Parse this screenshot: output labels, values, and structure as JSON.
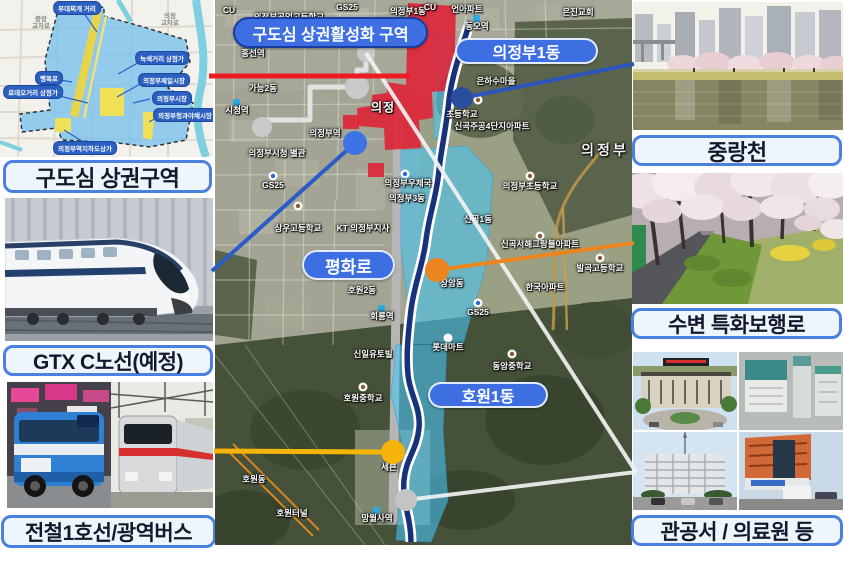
{
  "colors": {
    "caption_border": "#4a80e0",
    "caption_bg": "#eef5fd",
    "pill_blue": "#3d6fe3",
    "zone_red": "#e02034",
    "zone_cyan": "#48c6f5",
    "river_navy": "#17327a",
    "line_red": "#ed1c24",
    "line_yellow": "#f6b40a",
    "line_blue": "#2b5cc8",
    "line_orange": "#ec8420",
    "line_white": "#f2f2f2"
  },
  "captions": {
    "old_downtown": "구도심 상권구역",
    "gtx": "GTX C노선(예정)",
    "transit": "전철1호선/광역버스",
    "stream": "중랑천",
    "walkway": "수변 특화보행로",
    "public_offices": "관공서 / 의료원 등"
  },
  "map": {
    "activation_zone": "구도심 상권활성화 구역",
    "pills": [
      {
        "text": "의정부1동"
      },
      {
        "text": "평화로"
      },
      {
        "text": "호원1동"
      }
    ],
    "labels": [
      {
        "text": "CU",
        "x": 14,
        "y": 10
      },
      {
        "text": "의정부공업고등학교",
        "x": 74,
        "y": 17
      },
      {
        "text": "GS25",
        "x": 132,
        "y": 7
      },
      {
        "text": "의정부1동",
        "x": 193,
        "y": 11
      },
      {
        "text": "CU",
        "x": 215,
        "y": 7
      },
      {
        "text": "언아파트",
        "x": 252,
        "y": 9
      },
      {
        "text": "동오역",
        "x": 262,
        "y": 26
      },
      {
        "text": "은진교회",
        "x": 363,
        "y": 12
      },
      {
        "text": "흥선역",
        "x": 38,
        "y": 53
      },
      {
        "text": "가능2동",
        "x": 48,
        "y": 88
      },
      {
        "text": "시청역",
        "x": 22,
        "y": 110
      },
      {
        "text": "의정부역",
        "x": 110,
        "y": 133
      },
      {
        "text": "의정",
        "x": 168,
        "y": 107,
        "cls": "lg"
      },
      {
        "text": "의정부시청 별관",
        "x": 62,
        "y": 153
      },
      {
        "text": "GS25",
        "x": 58,
        "y": 185
      },
      {
        "text": "의정부우체국",
        "x": 193,
        "y": 183
      },
      {
        "text": "의정부3동",
        "x": 192,
        "y": 198
      },
      {
        "text": "은하수마을",
        "x": 281,
        "y": 81
      },
      {
        "text": "초등학교",
        "x": 247,
        "y": 114
      },
      {
        "text": "신곡주공4단지아파트",
        "x": 277,
        "y": 126
      },
      {
        "text": "의정부",
        "x": 390,
        "y": 150,
        "cls": "xl"
      },
      {
        "text": "의정부초등학교",
        "x": 315,
        "y": 186
      },
      {
        "text": "상우고등학교",
        "x": 83,
        "y": 228
      },
      {
        "text": "KT 의정부지사",
        "x": 148,
        "y": 228
      },
      {
        "text": "신곡1동",
        "x": 263,
        "y": 219
      },
      {
        "text": "신곡서해그랑블아파트",
        "x": 325,
        "y": 244
      },
      {
        "text": "발곡고등학교",
        "x": 385,
        "y": 268
      },
      {
        "text": "장암동",
        "x": 237,
        "y": 283
      },
      {
        "text": "한국아파트",
        "x": 330,
        "y": 287
      },
      {
        "text": "GS25",
        "x": 263,
        "y": 312
      },
      {
        "text": "호원2동",
        "x": 147,
        "y": 290
      },
      {
        "text": "회룡역",
        "x": 167,
        "y": 316
      },
      {
        "text": "롯데마트",
        "x": 233,
        "y": 347
      },
      {
        "text": "신일유토빌",
        "x": 158,
        "y": 354
      },
      {
        "text": "동암중학교",
        "x": 297,
        "y": 366
      },
      {
        "text": "호원중학교",
        "x": 148,
        "y": 398
      },
      {
        "text": "세븐",
        "x": 174,
        "y": 467
      },
      {
        "text": "호원동",
        "x": 39,
        "y": 479
      },
      {
        "text": "호원터널",
        "x": 77,
        "y": 513
      },
      {
        "text": "망월사역",
        "x": 162,
        "y": 518
      }
    ]
  },
  "diagram": {
    "pills": [
      {
        "text": "부대찌개 거리",
        "x": 77,
        "y": 8
      },
      {
        "text": "녹색거리 상점가",
        "x": 162,
        "y": 58
      },
      {
        "text": "행복로",
        "x": 49,
        "y": 78
      },
      {
        "text": "로데오거리 상점가",
        "x": 33,
        "y": 92
      },
      {
        "text": "의정부제일시장",
        "x": 164,
        "y": 80
      },
      {
        "text": "의정부시장",
        "x": 172,
        "y": 98
      },
      {
        "text": "의정부청과야채시장",
        "x": 185,
        "y": 115
      },
      {
        "text": "의정부역지하도상가",
        "x": 85,
        "y": 148
      }
    ],
    "roads": [
      {
        "text": "중앙",
        "x": 41,
        "y": 18
      },
      {
        "text": "교차로",
        "x": 41,
        "y": 25
      },
      {
        "text": "의정",
        "x": 170,
        "y": 15
      },
      {
        "text": "교차로",
        "x": 170,
        "y": 22
      }
    ]
  }
}
